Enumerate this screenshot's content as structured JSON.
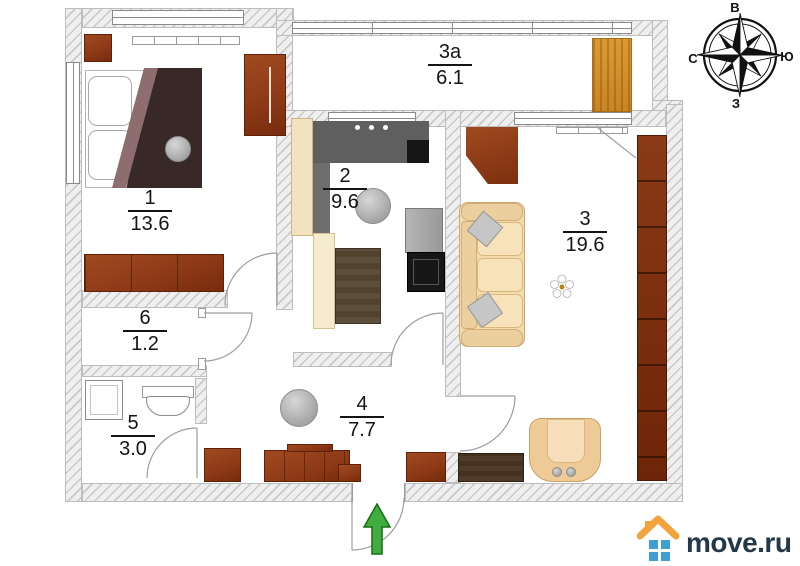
{
  "plan": {
    "rooms": [
      {
        "number": "1",
        "area": "13.6"
      },
      {
        "number": "2",
        "area": "9.6"
      },
      {
        "number": "3",
        "area": "19.6"
      },
      {
        "number": "3а",
        "area": "6.1"
      },
      {
        "number": "4",
        "area": "7.7"
      },
      {
        "number": "5",
        "area": "3.0"
      },
      {
        "number": "6",
        "area": "1.2"
      }
    ]
  },
  "compass": {
    "top": "В",
    "left": "С",
    "right": "Ю",
    "bottom": "З"
  },
  "logo": {
    "text": "move.ru"
  },
  "colors": {
    "wall_fill": "#efefef",
    "wall_hatch": "#c9c9c9",
    "wood_brown": "#8e3a17",
    "wood_dark": "#44311f",
    "sofa_beige": "#f4dbae",
    "balcony_wood": "#dc9a33",
    "appliance_dark": "#5f5f5f",
    "arrow_green": "#3fae3f",
    "logo_navy": "#24384a",
    "logo_orange": "#f2a33c",
    "logo_blue": "#3f9fd0"
  }
}
